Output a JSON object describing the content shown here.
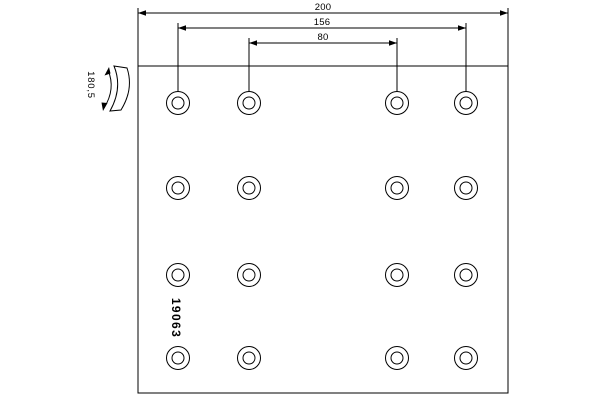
{
  "drawing": {
    "part_number": "19063",
    "dimensions": {
      "overall_length": "200",
      "outer_hole_spacing": "156",
      "inner_hole_spacing": "80",
      "arc_width": "180,5"
    },
    "holes": {
      "cols_x": [
        178,
        249,
        397,
        466
      ],
      "rows_y": [
        103,
        188,
        275,
        358
      ],
      "outer_radius": 11.5,
      "inner_radius": 6
    },
    "colors": {
      "line": "#000000",
      "background": "#ffffff"
    }
  }
}
